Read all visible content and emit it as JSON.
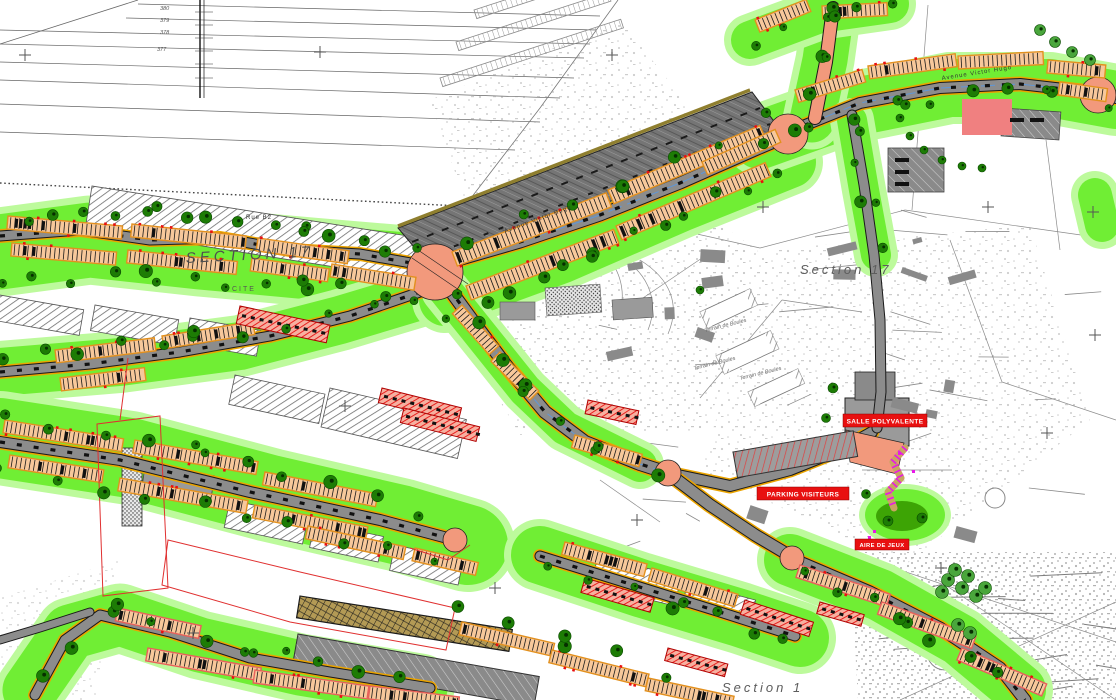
{
  "drawing": {
    "type": "urban landscape site plan (CAD)",
    "labels": {
      "section_17_left": "SECTION 17",
      "cite": "CITE",
      "section_17_right": "Section 17",
      "section_1": "Section 1",
      "rue_b2": "Rue B2",
      "avenue_1": "Avenue Victor Hugo",
      "avenue_2": "Avenue Victor Hugo",
      "terrain_1": "Terrain de Boules",
      "terrain_2": "Terrain de Boules",
      "terrain_3": "Terrain de Boules",
      "red_label_1": "SALLE POLYVALENTE",
      "red_label_2": "PARKING VISITEURS",
      "red_label_3": "AIRE DE JEUX",
      "contour_1": "380",
      "contour_2": "379",
      "contour_3": "378",
      "contour_4": "377"
    },
    "palette": {
      "grass": "#70ee34",
      "grass_halo": "#bdfa9c",
      "park_dark": "#3da405",
      "tree": "#1d7c05",
      "tree_medium": "#4aa63c",
      "road": "#8c8c8c",
      "road_dark_band": "#757575",
      "salmon": "#f2997c",
      "row_fill": "#f7c89b",
      "row_outline": "#e2901e",
      "row_outline_pink": "#e8605a",
      "red": "#e81010",
      "boundary_red": "#e03030",
      "magenta": "#e818e8",
      "blue_line": "#5f97d8",
      "curb_orange": "#eba400",
      "olive": "#8f7f2f",
      "tan_parking": "#b39a55",
      "pink_building": "#f08080",
      "hatch_gray": "#6e6e6e",
      "stipple_gray": "#8f8f8f"
    }
  }
}
